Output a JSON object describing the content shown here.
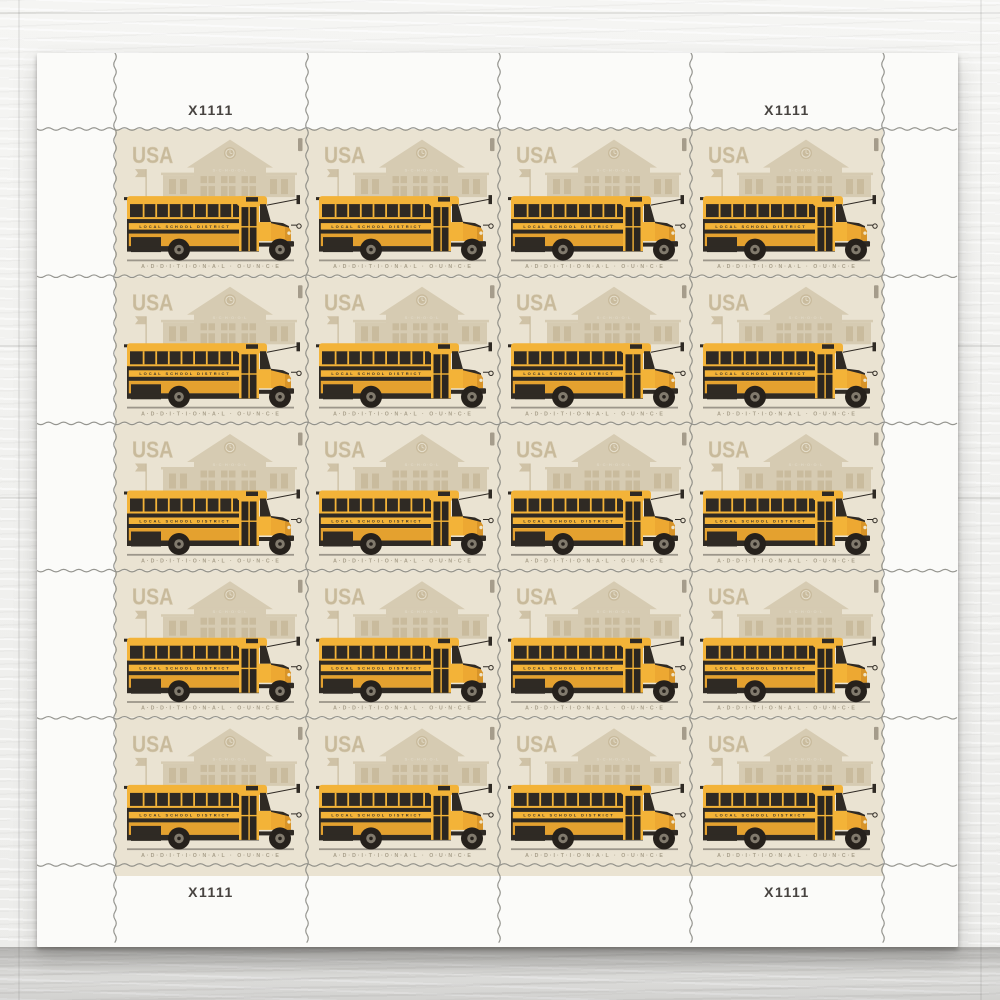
{
  "sheet": {
    "plate_number": "X1111",
    "rows": 5,
    "columns": 4,
    "stamp_count": 20
  },
  "stamp": {
    "country": "USA",
    "building_sign": "S·C·H·O·O·L",
    "bus_side_text": "LOCAL SCHOOL DISTRICT",
    "denomination_text": "A·D·D·I·T·I·O·N·A·L · O·U·N·C·E",
    "colors": {
      "stamp_background": "#eae3d2",
      "building_silhouette": "#d6cbb2",
      "building_window_tan": "#c9bb9d",
      "bus_yellow": "#f3b338",
      "bus_shadow_yellow": "#e4a12f",
      "detail_black": "#2f2a24",
      "usa_text_tan": "#c8ba9b",
      "denomination_tan": "#a89f8a",
      "selvage_white": "#fbfbf9",
      "perforation_gray": "#84847e"
    }
  }
}
